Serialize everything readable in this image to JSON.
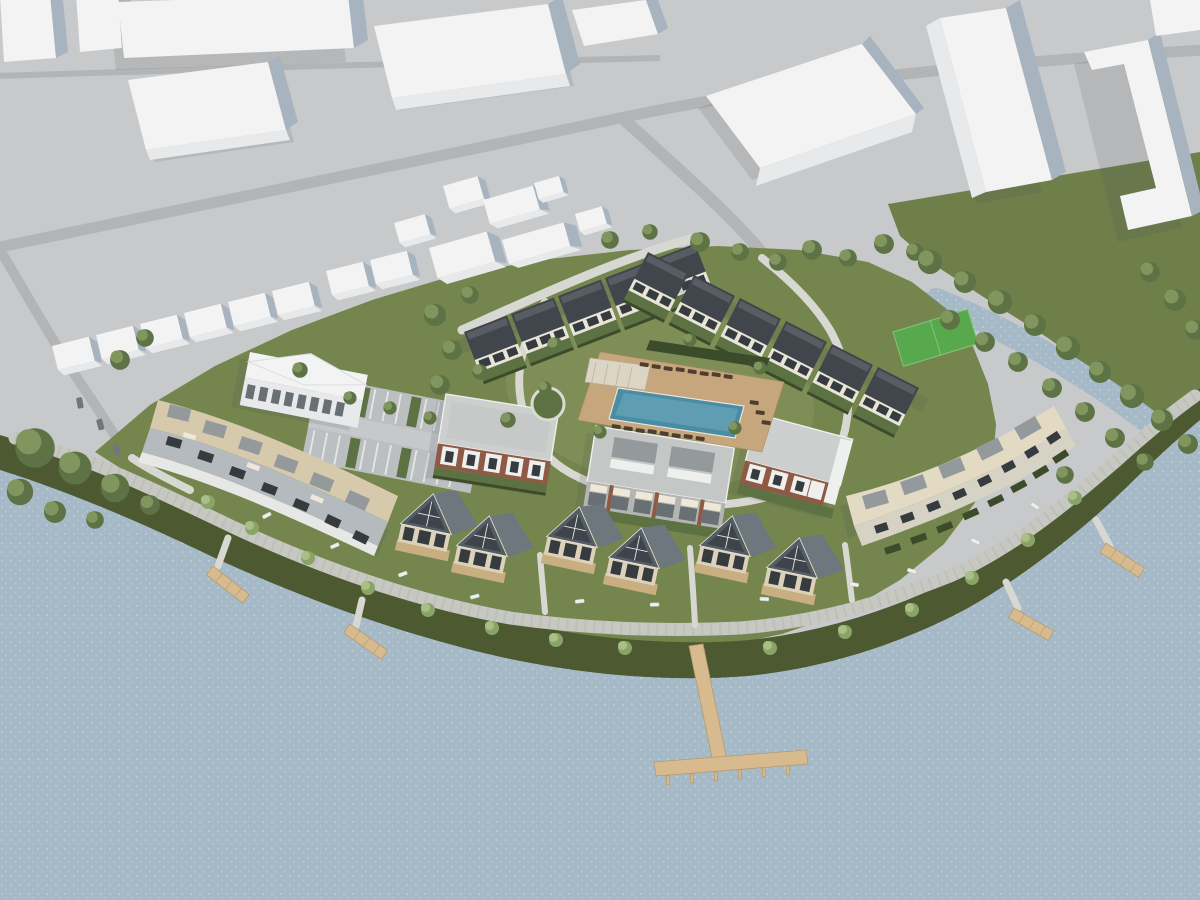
{
  "meta": {
    "type": "architectural-aerial-render",
    "description": "Aerial 3D visualization of a waterfront residential development: rows of dark-roof townhouses around a courtyard with a swimming pool and sun deck, brick apartment blocks, curved terraced buildings, gabled lakeside villas, a lakeside promenade with benches and trees, wooden piers including a large T-shaped pier, white massing blocks of the surrounding city, a parking lot, a bright green sports pitch, a tree-lined river and a large lake."
  },
  "colors": {
    "ground": "#c8c9cb",
    "road": "#b2b4b6",
    "path": "#d7d8d2",
    "promenade": "#c7c8c2",
    "promenade_dash": "#b7b8b1",
    "water": "#a6b9c7",
    "water_speckle": "#c3d2dd",
    "lawn": "#75854e",
    "lawn_light": "#7e8e56",
    "lawn_dark": "#4d5931",
    "field": "#6e7f4a",
    "pitch": "#58a84d",
    "garden": "#5d7243",
    "hedge": "#3c4c2b",
    "tree_base": "#5d7345",
    "tree_hi": "#80965e",
    "street_tree_base": "#8aa468",
    "street_tree_hi": "#a9bf85",
    "white_top": "#f2f3f2",
    "white_front": "#e7e9ea",
    "white_side": "#a7b4c0",
    "shadow": "#4a525a",
    "roof_dark": "#41464c",
    "roof_dark_hi": "#575d63",
    "th_wall": "#e9e4d8",
    "window": "#363b40",
    "brick": "#8e5a45",
    "roof_gray": "#cdcfcf",
    "roof_gray2": "#c5c7c6",
    "white_trim": "#eef0ee",
    "awning": "#efe8d9",
    "opening": "#697074",
    "e_roof": "#d7caac",
    "e_wall": "#b4babd",
    "g_roof": "#e3dac4",
    "g_wall": "#d6d2c4",
    "penthouse": "#949a9c",
    "villa_roof": "#545c64",
    "villa_roof_side": "#6e767e",
    "villa_glass": "#3d444b",
    "villa_body": "#dcd2ba",
    "villa_deck": "#c9ae82",
    "pool_deck": "#c6a67c",
    "pool_water": "#4b8ca5",
    "pool_water_light": "#6aa6ba",
    "lounger": "#4f3e2d",
    "pergola": "#dcd4c4",
    "pier": "#d7ba8d",
    "pier_edge": "#b59a6f",
    "bench": "#eef0ee",
    "car": "#6f767d"
  },
  "scene": {
    "townhouses_row_northwest": 5,
    "townhouses_row_northeast": 6,
    "apartment_buildings": 3,
    "terraced_buildings": 2,
    "gable_villas": 6,
    "context_buildings": 9,
    "garage_boxes": 15,
    "piers_small": 4,
    "pier_t_shaped": 1,
    "swimming_pool": 1,
    "sports_pitch": 1,
    "parking_lot": 1,
    "office_building": 1
  }
}
